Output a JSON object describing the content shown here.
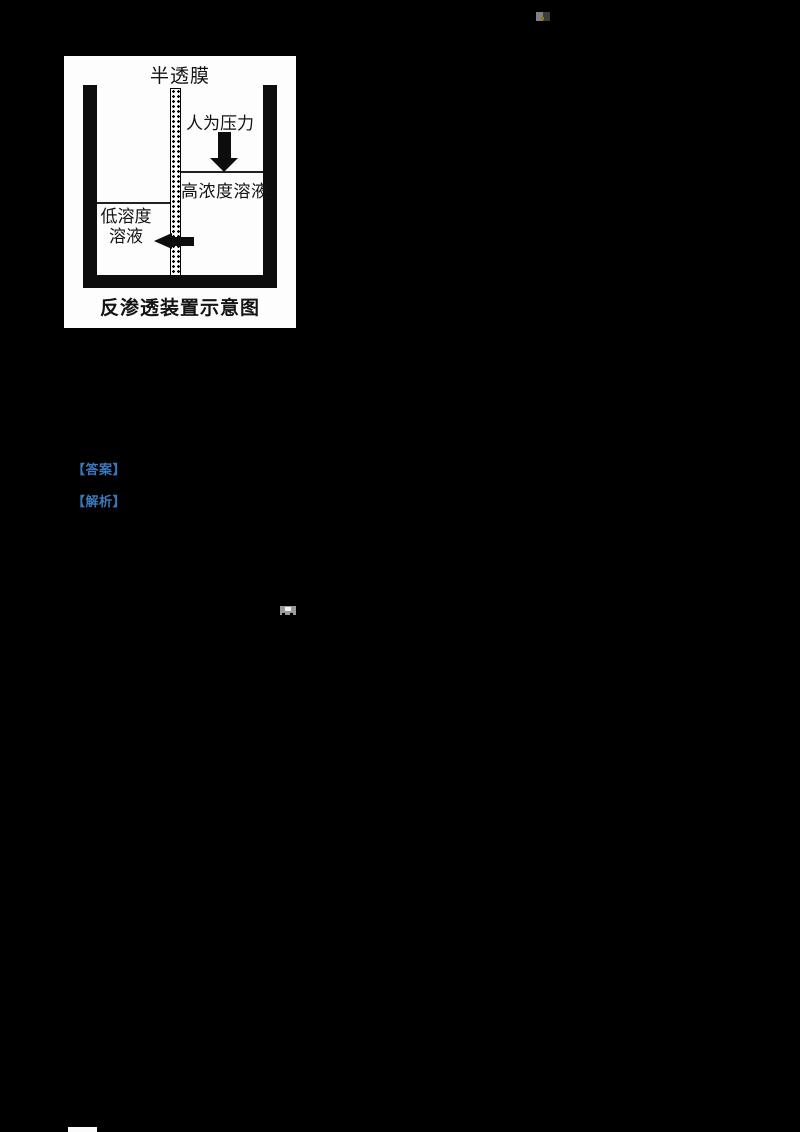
{
  "figure": {
    "caption": "反渗透装置示意图",
    "labels": {
      "membrane": "半透膜",
      "pressure": "人为压力",
      "high_solution": "高浓度溶液",
      "low_solution_line1": "低溶度",
      "low_solution_line2": "溶液"
    }
  },
  "answer_tags": [
    {
      "label": "【答案】"
    },
    {
      "label": "【解析】"
    }
  ],
  "colors": {
    "link_blue": "#3a78bb",
    "page_background": "#000000",
    "figure_background": "#fdfdfd"
  }
}
